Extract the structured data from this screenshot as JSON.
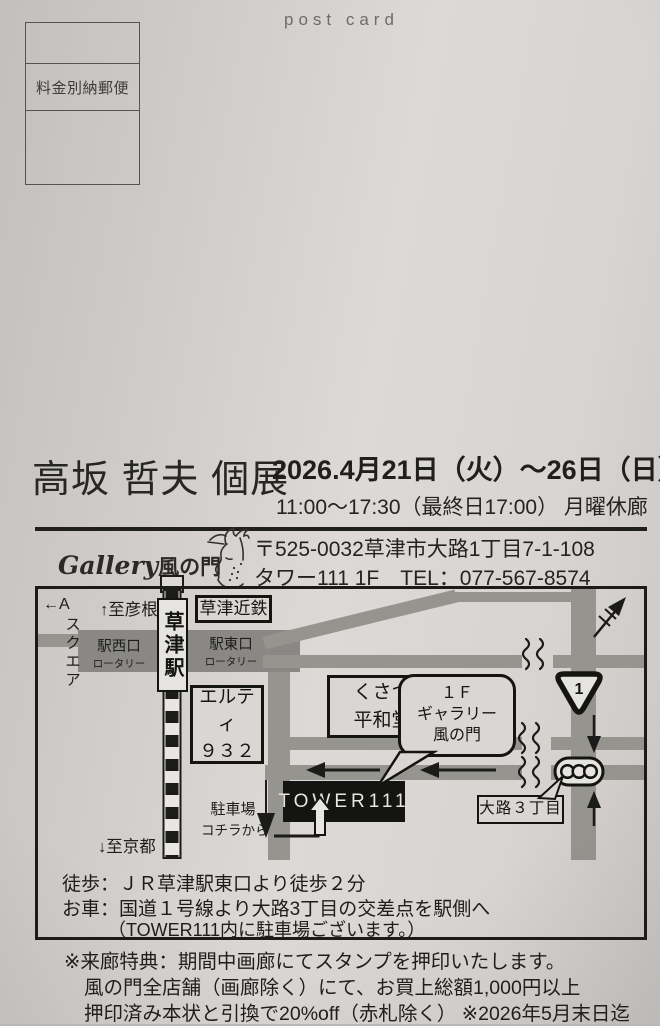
{
  "header": {
    "postcard_label": "post card",
    "postage_label": "料金別納郵便"
  },
  "exhibition": {
    "artist_title": "高坂 哲夫 個展",
    "dates": "2026.4月21日（火）～26日（日）",
    "hours": "11:00～17:30（最終日17:00） 月曜休廊"
  },
  "gallery": {
    "logo_script": "Gallery",
    "logo_kanji": "風の門",
    "postal_address": "〒525-0032草津市大路1丁目7-1-108",
    "building_tel": "タワー111 1F　TEL：077-567-8574"
  },
  "map": {
    "a_square_arrow": "←A",
    "a_square": "スクエア",
    "to_hikone": "↑至彦根",
    "to_kyoto": "↓至京都",
    "station": "草津駅",
    "kintetsu": "草津近鉄",
    "west_exit": "駅西口",
    "west_exit_sub": "ロータリー",
    "east_exit": "駅東口",
    "east_exit_sub": "ロータリー",
    "elty_line1": "エルティ",
    "elty_line2": "９３２",
    "heiwado_line1": "くさつ",
    "heiwado_line2": "平和堂",
    "bubble_line1": "１Ｆ",
    "bubble_line2": "ギャラリー",
    "bubble_line3": "風の門",
    "tower": "TOWER111",
    "parking_line1": "駐車場",
    "parking_line2": "コチラから",
    "oji_3chome": "大路３丁目",
    "route_number": "1"
  },
  "access": {
    "walk": "徒歩：ＪＲ草津駅東口より徒歩２分",
    "car_line1": "お車：国道１号線より大路3丁目の交差点を駅側へ",
    "car_line2": "（TOWER111内に駐車場ございます。）"
  },
  "notes": {
    "line1": "※来廊特典：期間中画廊にてスタンプを押印いたします。",
    "line2": "風の門全店舗（画廊除く）にて、お買上総額1,000円以上",
    "line3": "押印済み本状と引換で20%off（赤札除く） ※2026年5月末日迄"
  },
  "colors": {
    "ink": "#1b1b19",
    "road_gray": "#96948f",
    "rotary_gray": "#8a8884",
    "paper": "#d6d3d0"
  }
}
